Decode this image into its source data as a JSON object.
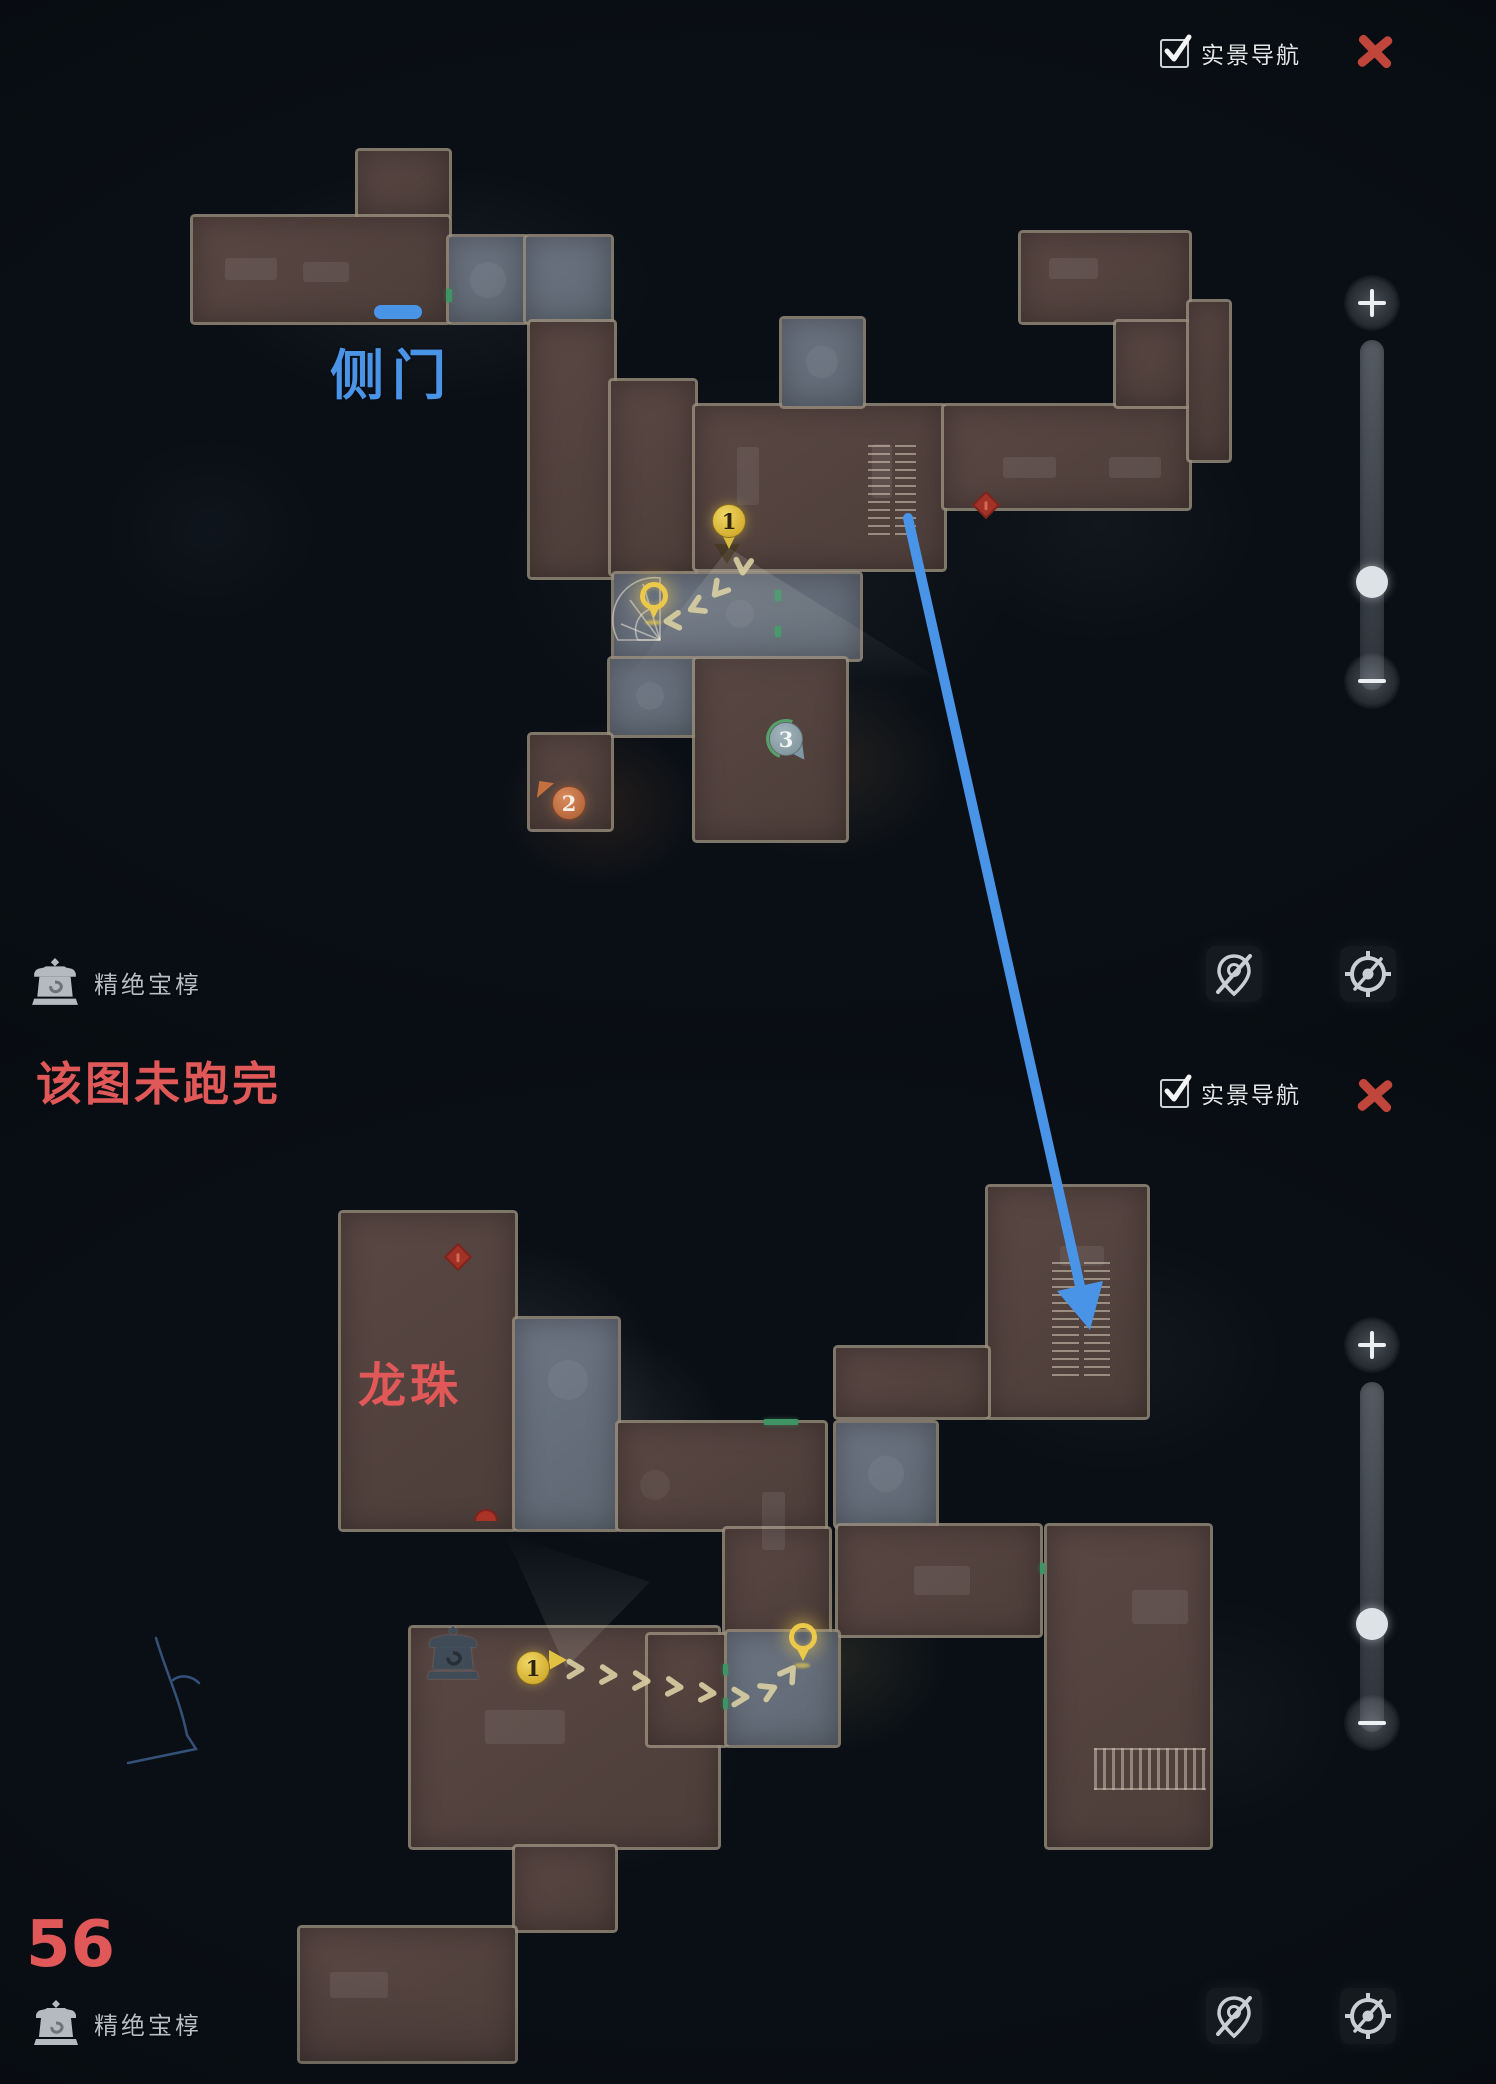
{
  "annotations": {
    "side_door": "侧门",
    "not_finished": "该图未跑完",
    "dragon_ball": "龙珠",
    "page_number": "56"
  },
  "panels": [
    {
      "nav_toggle": {
        "label": "实景导航",
        "checked": true
      },
      "hud": {
        "treasure_label": "精绝宝椁"
      },
      "markers": {
        "pin1": "1",
        "num2": "2",
        "num3": "3"
      }
    },
    {
      "nav_toggle": {
        "label": "实景导航",
        "checked": true
      },
      "hud": {
        "treasure_label": "精绝宝椁"
      },
      "markers": {
        "num1": "1"
      }
    }
  ],
  "colors": {
    "annotation_blue": "#4a94e8",
    "annotation_red": "#e05858",
    "close_red": "#c0463c",
    "marker_yellow": "#e7c647",
    "marker_orange": "#c9794e",
    "marker_teal": "#8fa6ad",
    "marker_green_ring": "#58a06a",
    "room_brown": "#53423e",
    "room_gray": "#67707d"
  }
}
